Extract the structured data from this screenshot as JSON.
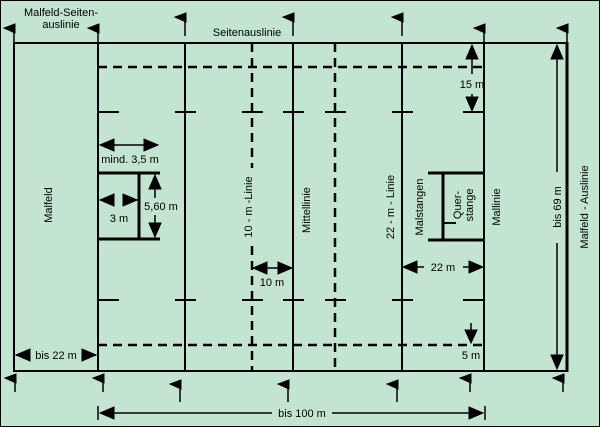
{
  "diagram": {
    "type": "rugby-field-plan",
    "colors": {
      "background": "#c2e4d0",
      "line": "#000000"
    },
    "labels": {
      "malfeld_seitenauslinie_1": "Malfeld-Seiten-",
      "malfeld_seitenauslinie_2": "auslinie",
      "seitenauslinie": "Seitenauslinie",
      "malfeld": "Malfeld",
      "zehn_m_linie": "10 - m -Linie",
      "mittellinie": "Mittellinie",
      "zweiundzwanzig_m_linie": "22 - m - Linie",
      "malstangen": "Malstangen",
      "querstange_1": "Quer-",
      "querstange_2": "stange",
      "mallinie": "Mallinie",
      "malfeld_auslinie": "Malfeld - Auslinie"
    },
    "measurements": {
      "fifteen_m": "15 m",
      "mind_3_5_m": "mind. 3,5 m",
      "three_m": "3 m",
      "five_sixty_m": "5,60 m",
      "ten_m": "10 m",
      "twentytwo_m": "22 m",
      "five_m": "5 m",
      "bis_22_m": "bis 22 m",
      "bis_69_m": "bis 69 m",
      "bis_100_m": "bis 100 m"
    }
  }
}
